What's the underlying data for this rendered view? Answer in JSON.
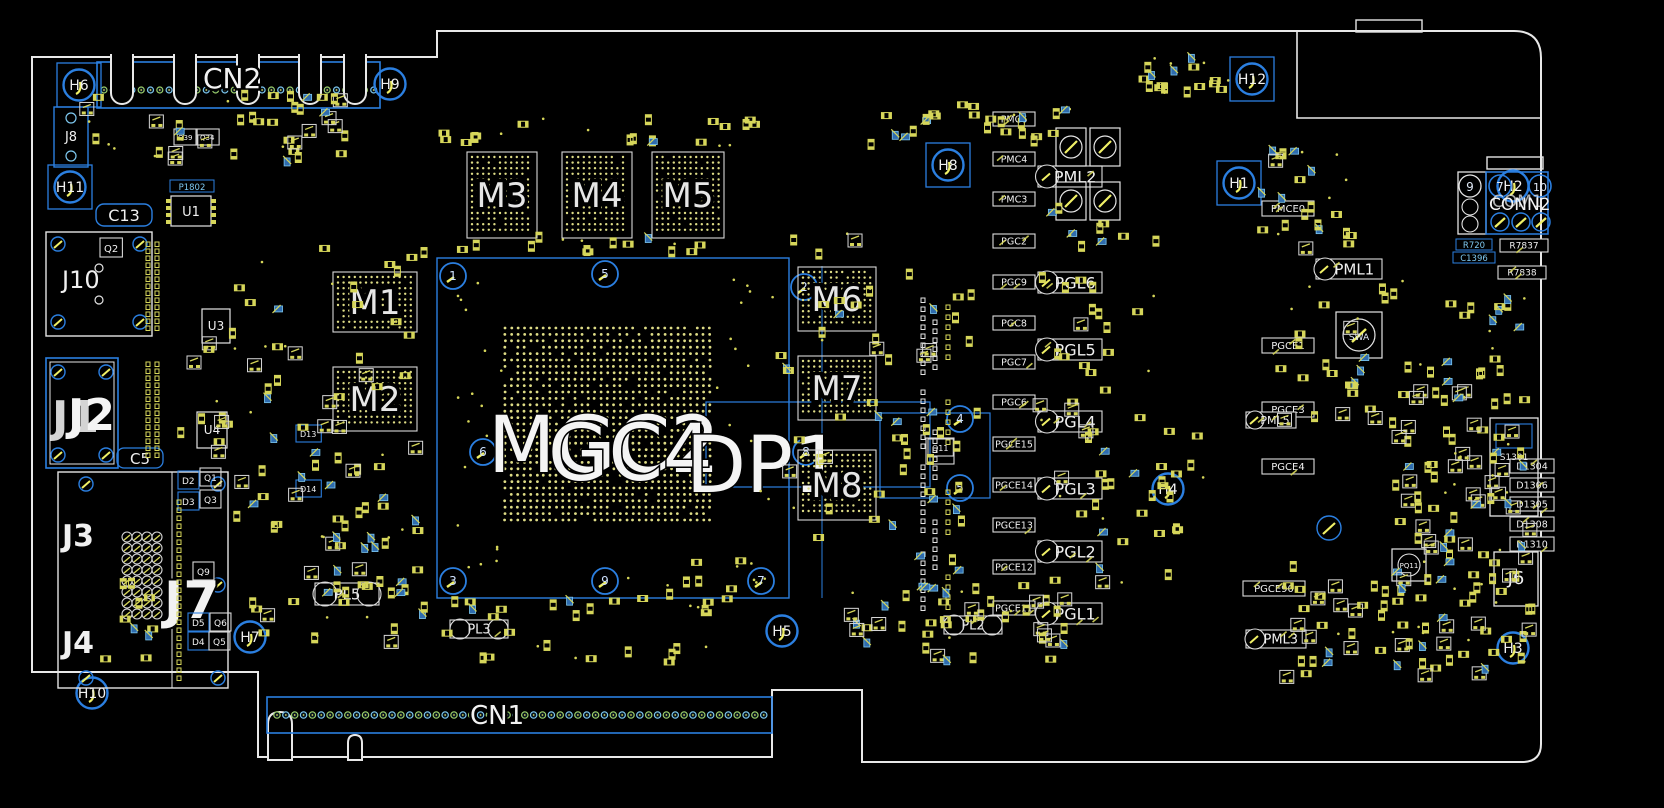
{
  "board": {
    "cn2": {
      "label": "CN2"
    },
    "cn1": {
      "label": "CN1"
    },
    "conn2": {
      "label": "CONN2",
      "alt": "COM1",
      "pins": [
        "9",
        "7",
        "10"
      ]
    },
    "gpu_labels": [
      {
        "text": "MGC2",
        "x": 488,
        "y": 472
      },
      {
        "text": "GC4",
        "x": 548,
        "y": 480
      },
      {
        "text": "DP1",
        "x": 686,
        "y": 492
      }
    ]
  },
  "memories": [
    {
      "id": "M1",
      "x": 333,
      "y": 272,
      "w": 84,
      "h": 60
    },
    {
      "id": "M2",
      "x": 333,
      "y": 367,
      "w": 84,
      "h": 64
    },
    {
      "id": "M3",
      "x": 467,
      "y": 152,
      "w": 70,
      "h": 86
    },
    {
      "id": "M4",
      "x": 562,
      "y": 152,
      "w": 70,
      "h": 86
    },
    {
      "id": "M5",
      "x": 652,
      "y": 152,
      "w": 72,
      "h": 86
    },
    {
      "id": "M6",
      "x": 798,
      "y": 267,
      "w": 78,
      "h": 64
    },
    {
      "id": "M7",
      "x": 798,
      "y": 356,
      "w": 78,
      "h": 64
    },
    {
      "id": "M8",
      "x": 798,
      "y": 450,
      "w": 78,
      "h": 70
    }
  ],
  "holes": [
    {
      "id": "H6",
      "x": 79,
      "y": 85,
      "sq": 1
    },
    {
      "id": "H9",
      "x": 390,
      "y": 84,
      "sq": 0
    },
    {
      "id": "H12",
      "x": 1252,
      "y": 79,
      "sq": 1
    },
    {
      "id": "H11",
      "x": 70,
      "y": 187,
      "sq": 1
    },
    {
      "id": "H8",
      "x": 948,
      "y": 165,
      "sq": 1
    },
    {
      "id": "H1",
      "x": 1239,
      "y": 183,
      "sq": 1
    },
    {
      "id": "H2",
      "x": 1513,
      "y": 186,
      "sq": 0
    },
    {
      "id": "H4",
      "x": 1168,
      "y": 489,
      "sq": 0
    },
    {
      "id": "H5",
      "x": 782,
      "y": 631,
      "sq": 0
    },
    {
      "id": "H7",
      "x": 250,
      "y": 637,
      "sq": 0
    },
    {
      "id": "H3",
      "x": 1513,
      "y": 648,
      "sq": 0
    },
    {
      "id": "H10",
      "x": 92,
      "y": 693,
      "sq": 0
    }
  ],
  "fiducials": [
    {
      "n": "1",
      "x": 453,
      "y": 276
    },
    {
      "n": "5",
      "x": 605,
      "y": 274
    },
    {
      "n": "2",
      "x": 804,
      "y": 287
    },
    {
      "n": "6",
      "x": 483,
      "y": 452
    },
    {
      "n": "8",
      "x": 806,
      "y": 452
    },
    {
      "n": "3",
      "x": 453,
      "y": 581
    },
    {
      "n": "9",
      "x": 605,
      "y": 581
    },
    {
      "n": "7",
      "x": 761,
      "y": 581
    },
    {
      "n": "4",
      "x": 960,
      "y": 419
    },
    {
      "n": "5",
      "x": 960,
      "y": 488
    }
  ],
  "power_labels": [
    {
      "text": "PML2",
      "y": 166
    },
    {
      "text": "PGL6",
      "y": 272
    },
    {
      "text": "PGL5",
      "y": 339
    },
    {
      "text": "PGL4",
      "y": 411
    },
    {
      "text": "PGL3",
      "y": 478
    },
    {
      "text": "PGL2",
      "y": 541
    },
    {
      "text": "PGL1",
      "y": 603
    }
  ],
  "vrm_labels": [
    {
      "text": "PMC6",
      "y": 112
    },
    {
      "text": "PMC4",
      "y": 152
    },
    {
      "text": "PMC3",
      "y": 192
    },
    {
      "text": "PGC2",
      "y": 234
    },
    {
      "text": "PGC9",
      "y": 275
    },
    {
      "text": "PGC8",
      "y": 316
    },
    {
      "text": "PGC7",
      "y": 355
    },
    {
      "text": "PGC6",
      "y": 395
    },
    {
      "text": "PGCE15",
      "y": 437
    },
    {
      "text": "PGCE14",
      "y": 478
    },
    {
      "text": "PGCE13",
      "y": 518
    },
    {
      "text": "PGCE12",
      "y": 560
    },
    {
      "text": "PGCE11",
      "y": 601
    }
  ],
  "right_labels": [
    {
      "text": "PMCE0",
      "x": 1262,
      "y": 201,
      "w": 52,
      "h": 15,
      "fs": 10
    },
    {
      "text": "PGCE1",
      "x": 1262,
      "y": 338,
      "w": 52,
      "h": 15,
      "fs": 10
    },
    {
      "text": "PGCE3",
      "x": 1262,
      "y": 402,
      "w": 52,
      "h": 15,
      "fs": 10
    },
    {
      "text": "PGCE4",
      "x": 1262,
      "y": 459,
      "w": 52,
      "h": 15,
      "fs": 10
    },
    {
      "text": "PGCE90",
      "x": 1243,
      "y": 581,
      "w": 62,
      "h": 15,
      "fs": 10
    },
    {
      "text": "PML5",
      "x": 1246,
      "y": 412,
      "w": 50,
      "h": 16,
      "fs": 11
    },
    {
      "text": "PML1",
      "x": 1316,
      "y": 259,
      "w": 66,
      "h": 20,
      "fs": 15
    },
    {
      "text": "PML3",
      "x": 1246,
      "y": 630,
      "w": 60,
      "h": 18,
      "fs": 13
    },
    {
      "text": "R7837",
      "x": 1500,
      "y": 239,
      "w": 48,
      "h": 13,
      "fs": 9
    },
    {
      "text": "R7838",
      "x": 1498,
      "y": 266,
      "w": 48,
      "h": 13,
      "fs": 9
    }
  ],
  "diode_labels": [
    {
      "text": "D1304",
      "y": 459
    },
    {
      "text": "D1306",
      "y": 478
    },
    {
      "text": "D1305",
      "y": 497
    },
    {
      "text": "D1308",
      "y": 517
    },
    {
      "text": "D1310",
      "y": 537
    }
  ],
  "left": {
    "j8": "J8",
    "c13": "C13",
    "u1": "U1",
    "p1802": "P1802",
    "j10": "J10",
    "u3": "U3",
    "j1": "J1",
    "j2": "J2",
    "u4": "U4",
    "c5": "C5",
    "j3": "J3",
    "j7": "J7",
    "j4": "J4"
  },
  "right": {
    "j6": "J6",
    "s1301": "S1301",
    "swa": "SWA",
    "pq11": "PQ11",
    "r720": "R720",
    "c1396": "C1396"
  },
  "inductors": [
    {
      "text": "PL5",
      "x": 315,
      "y": 583,
      "w": 64,
      "h": 22,
      "fs": 15
    },
    {
      "text": "PL3",
      "x": 450,
      "y": 620,
      "w": 58,
      "h": 18,
      "fs": 13
    },
    {
      "text": "PL2",
      "x": 944,
      "y": 616,
      "w": 58,
      "h": 18,
      "fs": 13
    }
  ],
  "small_refs": [
    {
      "text": "Q2",
      "x": 104,
      "y": 252,
      "fs": 10,
      "b": 2
    },
    {
      "text": "Q39",
      "x": 178,
      "y": 140,
      "fs": 7,
      "b": 2
    },
    {
      "text": "Q34",
      "x": 200,
      "y": 140,
      "fs": 7,
      "b": 2
    },
    {
      "text": "D2",
      "x": 182,
      "y": 484,
      "fs": 9,
      "b": 1
    },
    {
      "text": "D3",
      "x": 182,
      "y": 505,
      "fs": 9,
      "b": 1
    },
    {
      "text": "Q1",
      "x": 204,
      "y": 481,
      "fs": 9,
      "b": 2
    },
    {
      "text": "Q3",
      "x": 204,
      "y": 503,
      "fs": 9,
      "b": 2
    },
    {
      "text": "Q9",
      "x": 197,
      "y": 575,
      "fs": 9,
      "b": 2
    },
    {
      "text": "D5",
      "x": 192,
      "y": 626,
      "fs": 9,
      "b": 1
    },
    {
      "text": "D4",
      "x": 192,
      "y": 645,
      "fs": 9,
      "b": 1
    },
    {
      "text": "Q6",
      "x": 214,
      "y": 626,
      "fs": 9,
      "b": 2
    },
    {
      "text": "Q5",
      "x": 213,
      "y": 645,
      "fs": 9,
      "b": 2
    },
    {
      "text": "Q11",
      "x": 932,
      "y": 451,
      "fs": 8,
      "b": 2
    },
    {
      "text": "D13",
      "x": 300,
      "y": 437,
      "fs": 8,
      "b": 1
    },
    {
      "text": "D14",
      "x": 300,
      "y": 492,
      "fs": 8,
      "b": 1
    }
  ]
}
